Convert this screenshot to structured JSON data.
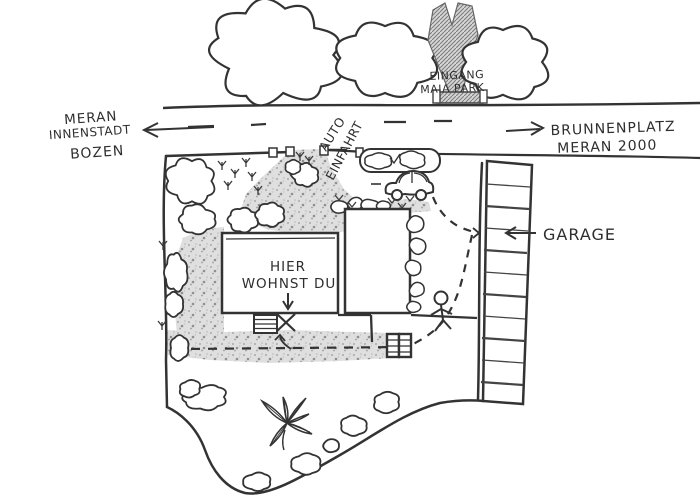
{
  "map": {
    "title": "hand-drawn site plan",
    "labels": {
      "road_left": {
        "line1": "MERAN",
        "line2": "INNENSTADT",
        "line3": "BOZEN"
      },
      "road_right": {
        "line1": "BRUNNENPLATZ",
        "line2": "MERAN 2000"
      },
      "park_entrance": {
        "line1": "EINGANG",
        "line2": "MAIA PARK"
      },
      "driveway": {
        "line1": "AUTO",
        "line2": "EINFAHRT"
      },
      "house": {
        "line1": "HIER",
        "line2": "WOHNST DU"
      },
      "garage": {
        "label": "GARAGE"
      }
    },
    "icons": {
      "trees": "cloud-tree-icon",
      "bushes": "bush-icon",
      "car": "car-icon",
      "person": "stick-figure-icon",
      "palm": "palm-plant-icon",
      "gate": "garden-gate-icon",
      "steps": "entrance-steps-icon",
      "spot_marker": "x-mark-icon"
    },
    "colors": {
      "ink": "#333333",
      "paper": "#ffffff",
      "gravel": "#dfdfdf",
      "shading": "#8f8f8f"
    }
  }
}
